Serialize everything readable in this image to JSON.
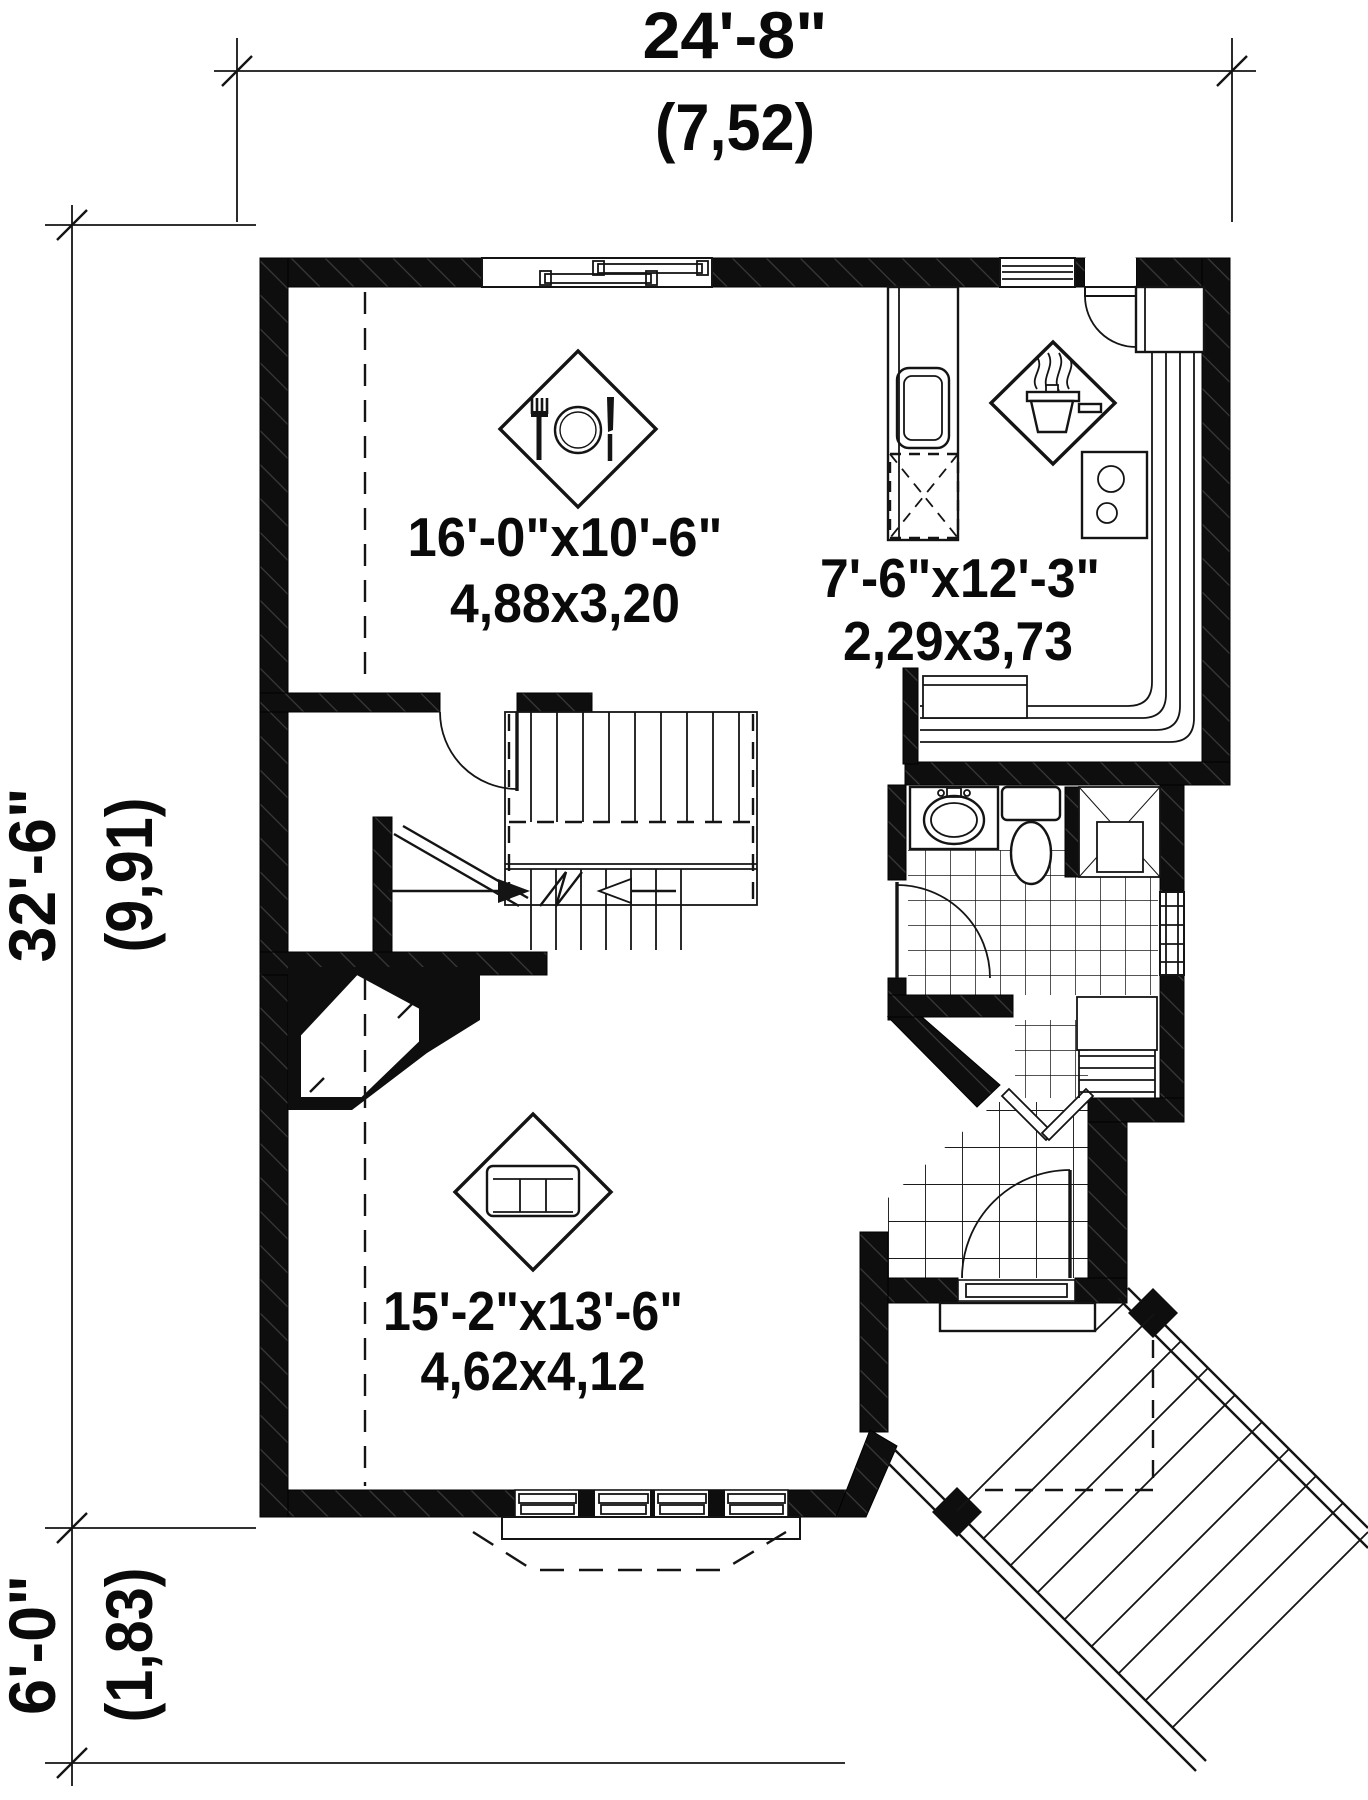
{
  "dimensions": {
    "width_total": {
      "imperial": "24'-8\"",
      "metric": "(7,52)"
    },
    "height_main": {
      "imperial": "32'-6\"",
      "metric": "(9,91)"
    },
    "height_porch": {
      "imperial": "6'-0\"",
      "metric": "(1,83)"
    }
  },
  "rooms": {
    "dining": {
      "imperial": "16'-0\"x10'-6\"",
      "metric": "4,88x3,20",
      "icon": "dining-table-icon"
    },
    "kitchen": {
      "imperial": "7'-6\"x12'-3\"",
      "metric": "2,29x3,73",
      "icon": "cooking-pot-icon"
    },
    "living": {
      "imperial": "15'-2\"x13'-6\"",
      "metric": "4,62x4,12",
      "icon": "sofa-icon"
    }
  },
  "colors": {
    "wall": "#0e0e0e",
    "line": "#141414",
    "background": "#ffffff"
  }
}
